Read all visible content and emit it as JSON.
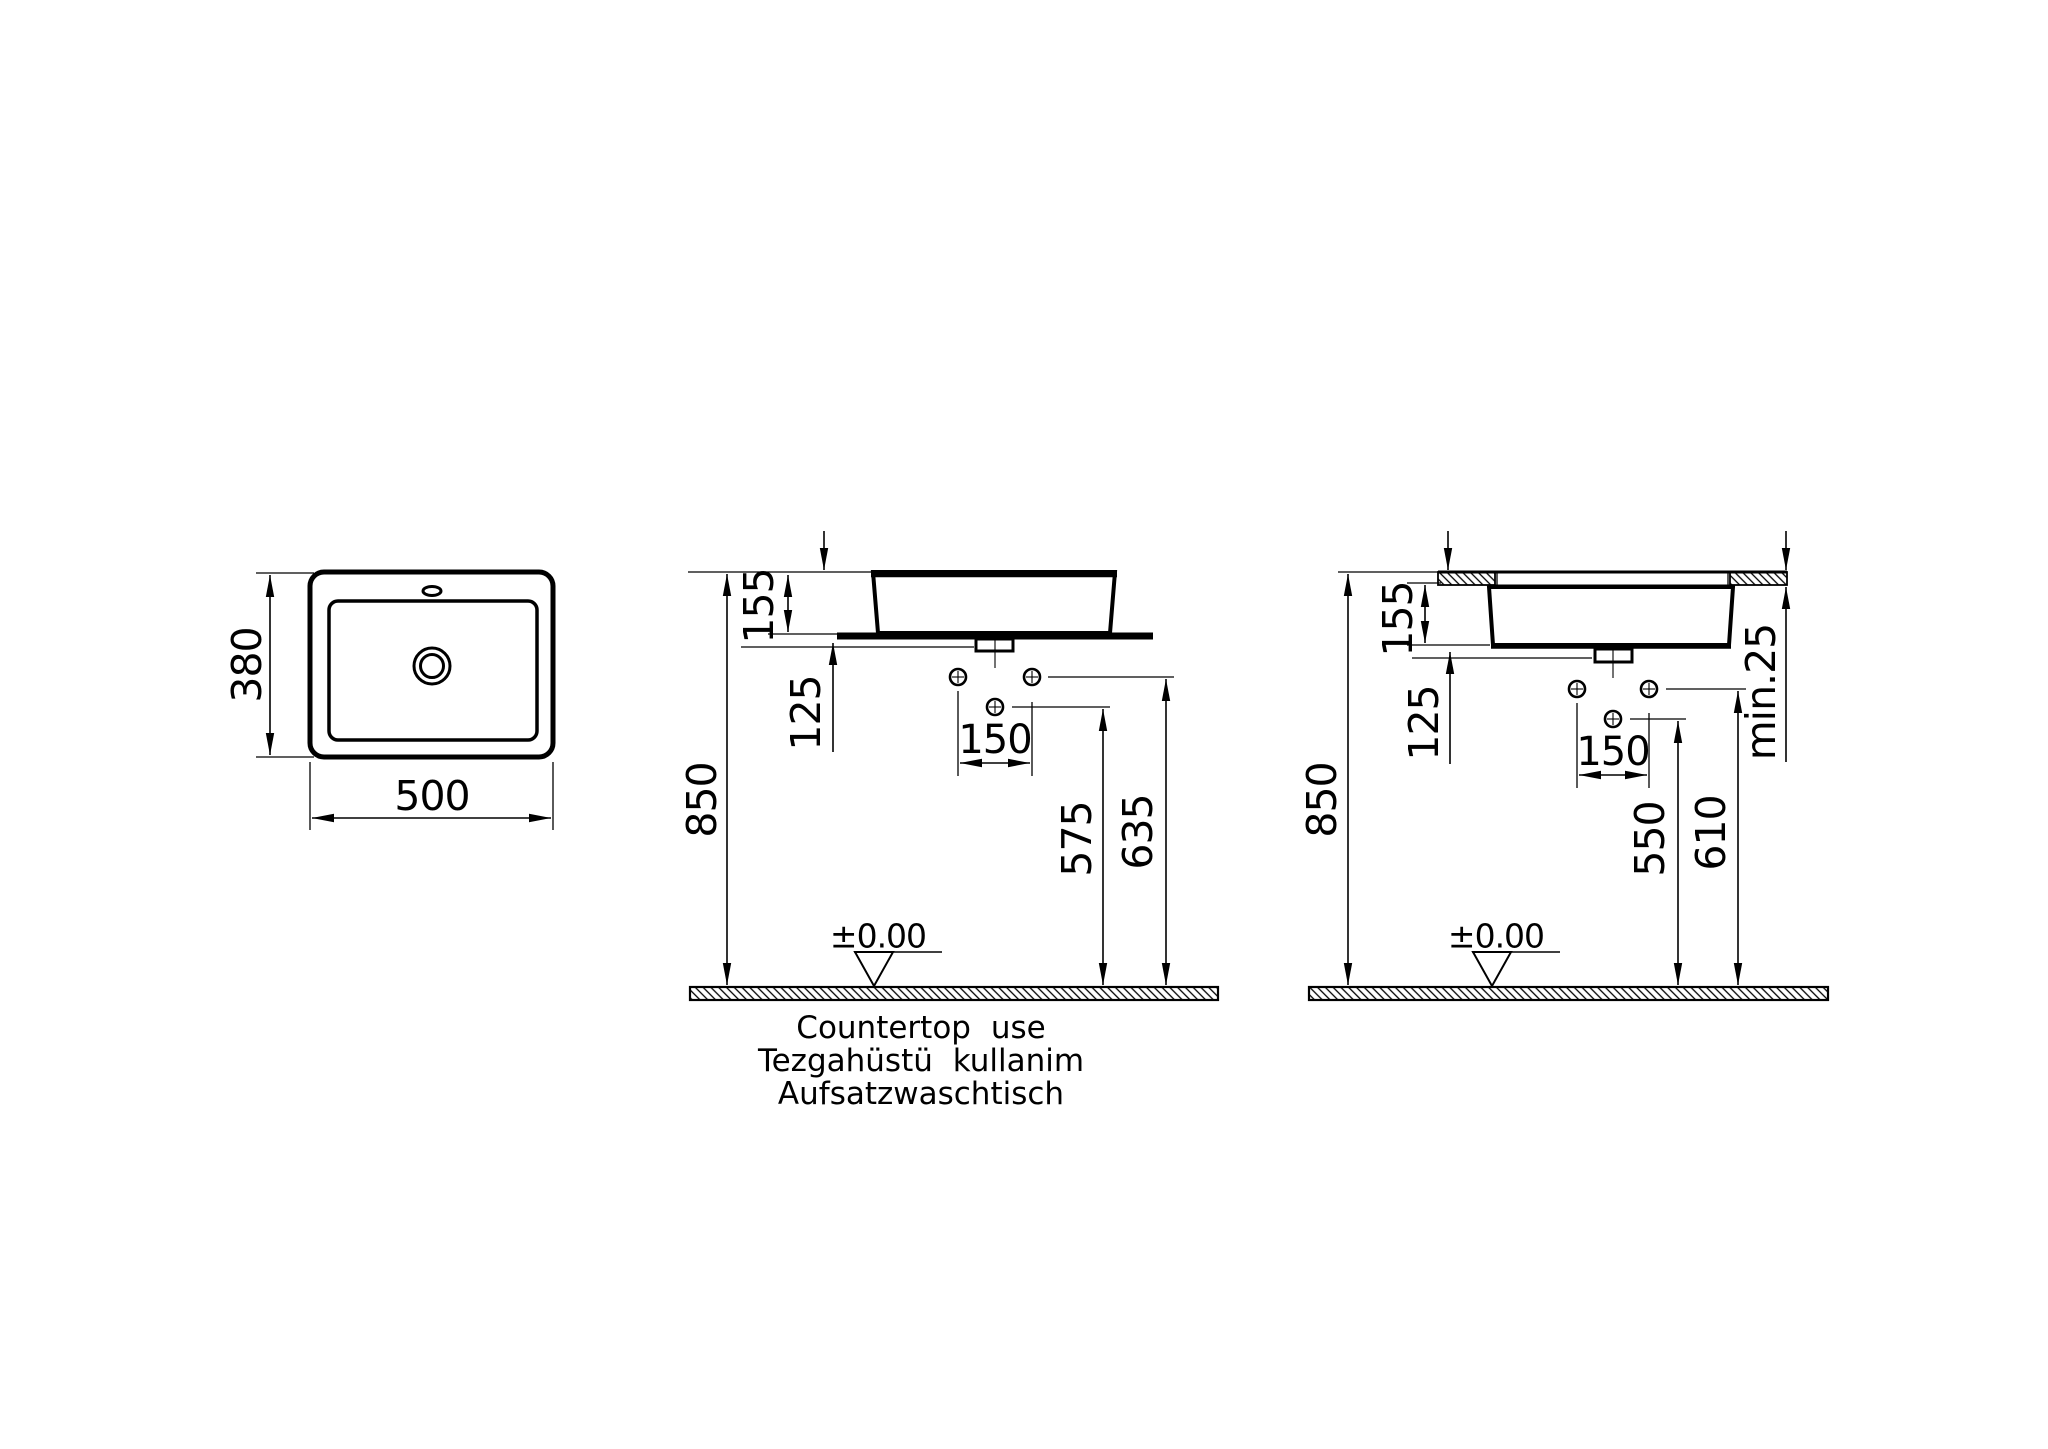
{
  "page": {
    "background": "#ffffff",
    "line_color": "#000000",
    "type_label": "technical installation drawing"
  },
  "captions": {
    "line1": "Countertop use",
    "line2": "Tezgahüstü kullanim",
    "line3": "Aufsatzwaschtisch"
  },
  "top_view": {
    "depth": "380",
    "width": "500"
  },
  "front_view": {
    "total_height": "850",
    "basin_height": "155",
    "below_countertop": "125",
    "hole_spacing": "150",
    "drain_height": "575",
    "supply_height": "635",
    "floor_datum": "±0.00"
  },
  "recessed_view": {
    "total_height": "850",
    "basin_height": "155",
    "below_basin": "125",
    "hole_spacing": "150",
    "drain_height": "550",
    "supply_height": "610",
    "min_countertop": "min.25",
    "floor_datum": "±0.00"
  }
}
